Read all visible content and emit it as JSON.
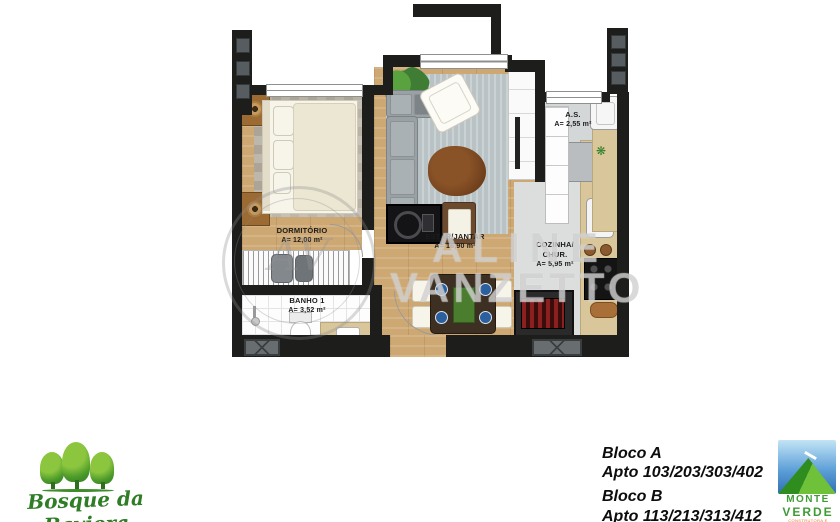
{
  "plan": {
    "rooms": [
      {
        "id": "dormitorio",
        "name": "DORMITÓRIO",
        "area": "A= 12,00 m²"
      },
      {
        "id": "banho1",
        "name": "BANHO 1",
        "area": "A= 3,52 m²"
      },
      {
        "id": "estar_jantar",
        "name": "ESTAR/JANTAR",
        "area": "A= 16,90 m²"
      },
      {
        "id": "cozinha_chur",
        "name": "COZINHA/",
        "name2": "CHUR.",
        "area": "A= 5,95 m²"
      },
      {
        "id": "area_servico",
        "name": "A.S.",
        "area": "A= 2,55 m²"
      }
    ]
  },
  "watermark": {
    "line1": "ALINE",
    "line2": "VANZETTO",
    "monogram": "AV"
  },
  "footer": {
    "left_logo": {
      "name": "Bosque da Baviera"
    },
    "blocks": [
      {
        "bloco": "Bloco A",
        "aptos": "Apto 103/203/303/402"
      },
      {
        "bloco": "Bloco B",
        "aptos": "Apto 113/213/313/412"
      }
    ],
    "right_logo": {
      "line1": "MONTE",
      "line2": "VERDE",
      "tagline": "CONSTRUTORA E INCORPORADORA"
    }
  },
  "colors": {
    "wall": "#1d1d1b",
    "wood_floor": "#cda873",
    "gray_tile": "#d3d7d8",
    "counter_beige": "#d9c79b",
    "rug_blue_gray": "#b9c3c6",
    "brand_green": "#3f9c35",
    "script_green": "#2f7d26",
    "text_black": "#0d0d0d",
    "watermark_gray": "#b9b9b9"
  }
}
